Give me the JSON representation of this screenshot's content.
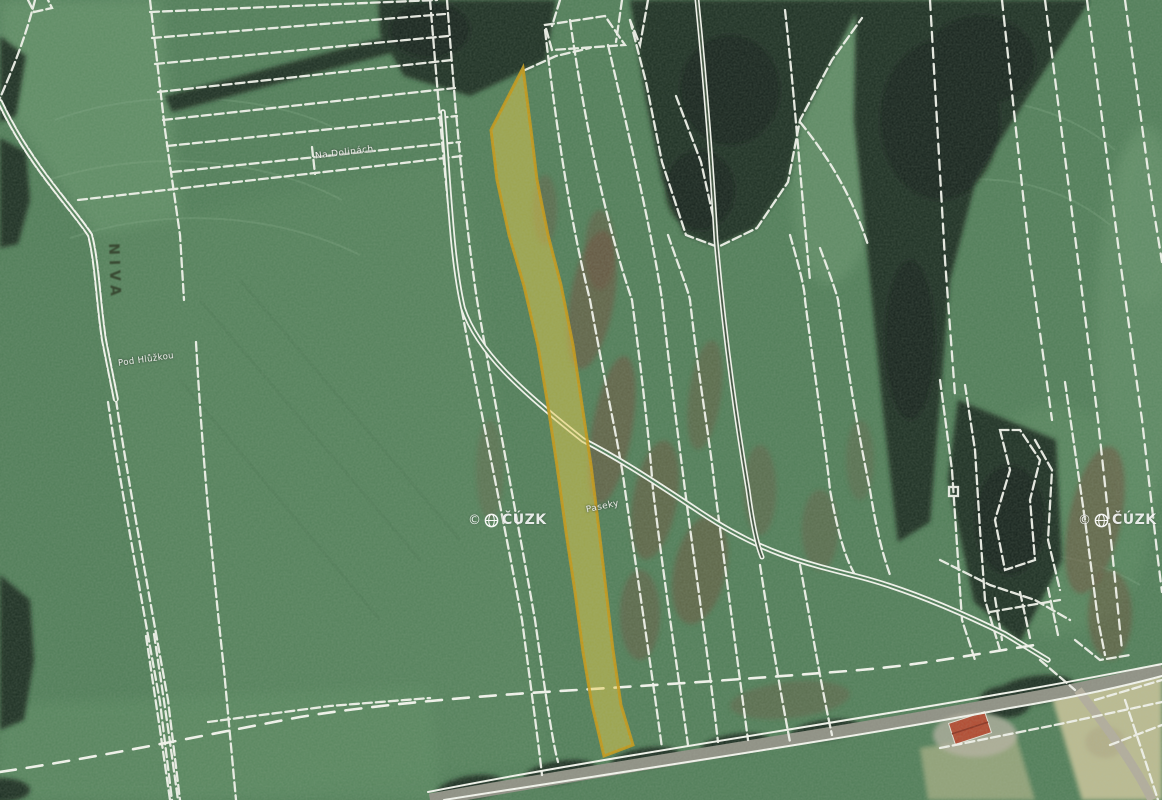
{
  "map": {
    "kind": "cadastral parcel map over aerial orthophoto",
    "field_labels": {
      "na_dolinach": "Na Dolinách",
      "pod_hluzkou": "Pod Hlůžkou",
      "niva": "NIVA",
      "paseky": "Paseky"
    },
    "watermark": {
      "copyright_symbol": "©",
      "organization": "ČÚZK"
    },
    "highlighted_parcel": {
      "fill": "#e9cb3f",
      "stroke": "#c7970f"
    },
    "colors": {
      "parcel_line": "#f7f7f1",
      "field_green": "#4f7d57",
      "forest_dark": "#1e2d21",
      "soil_red_brown": "#6f4a37",
      "road_gray": "#8f8f84",
      "bare_field_beige": "#cfc69a"
    }
  }
}
